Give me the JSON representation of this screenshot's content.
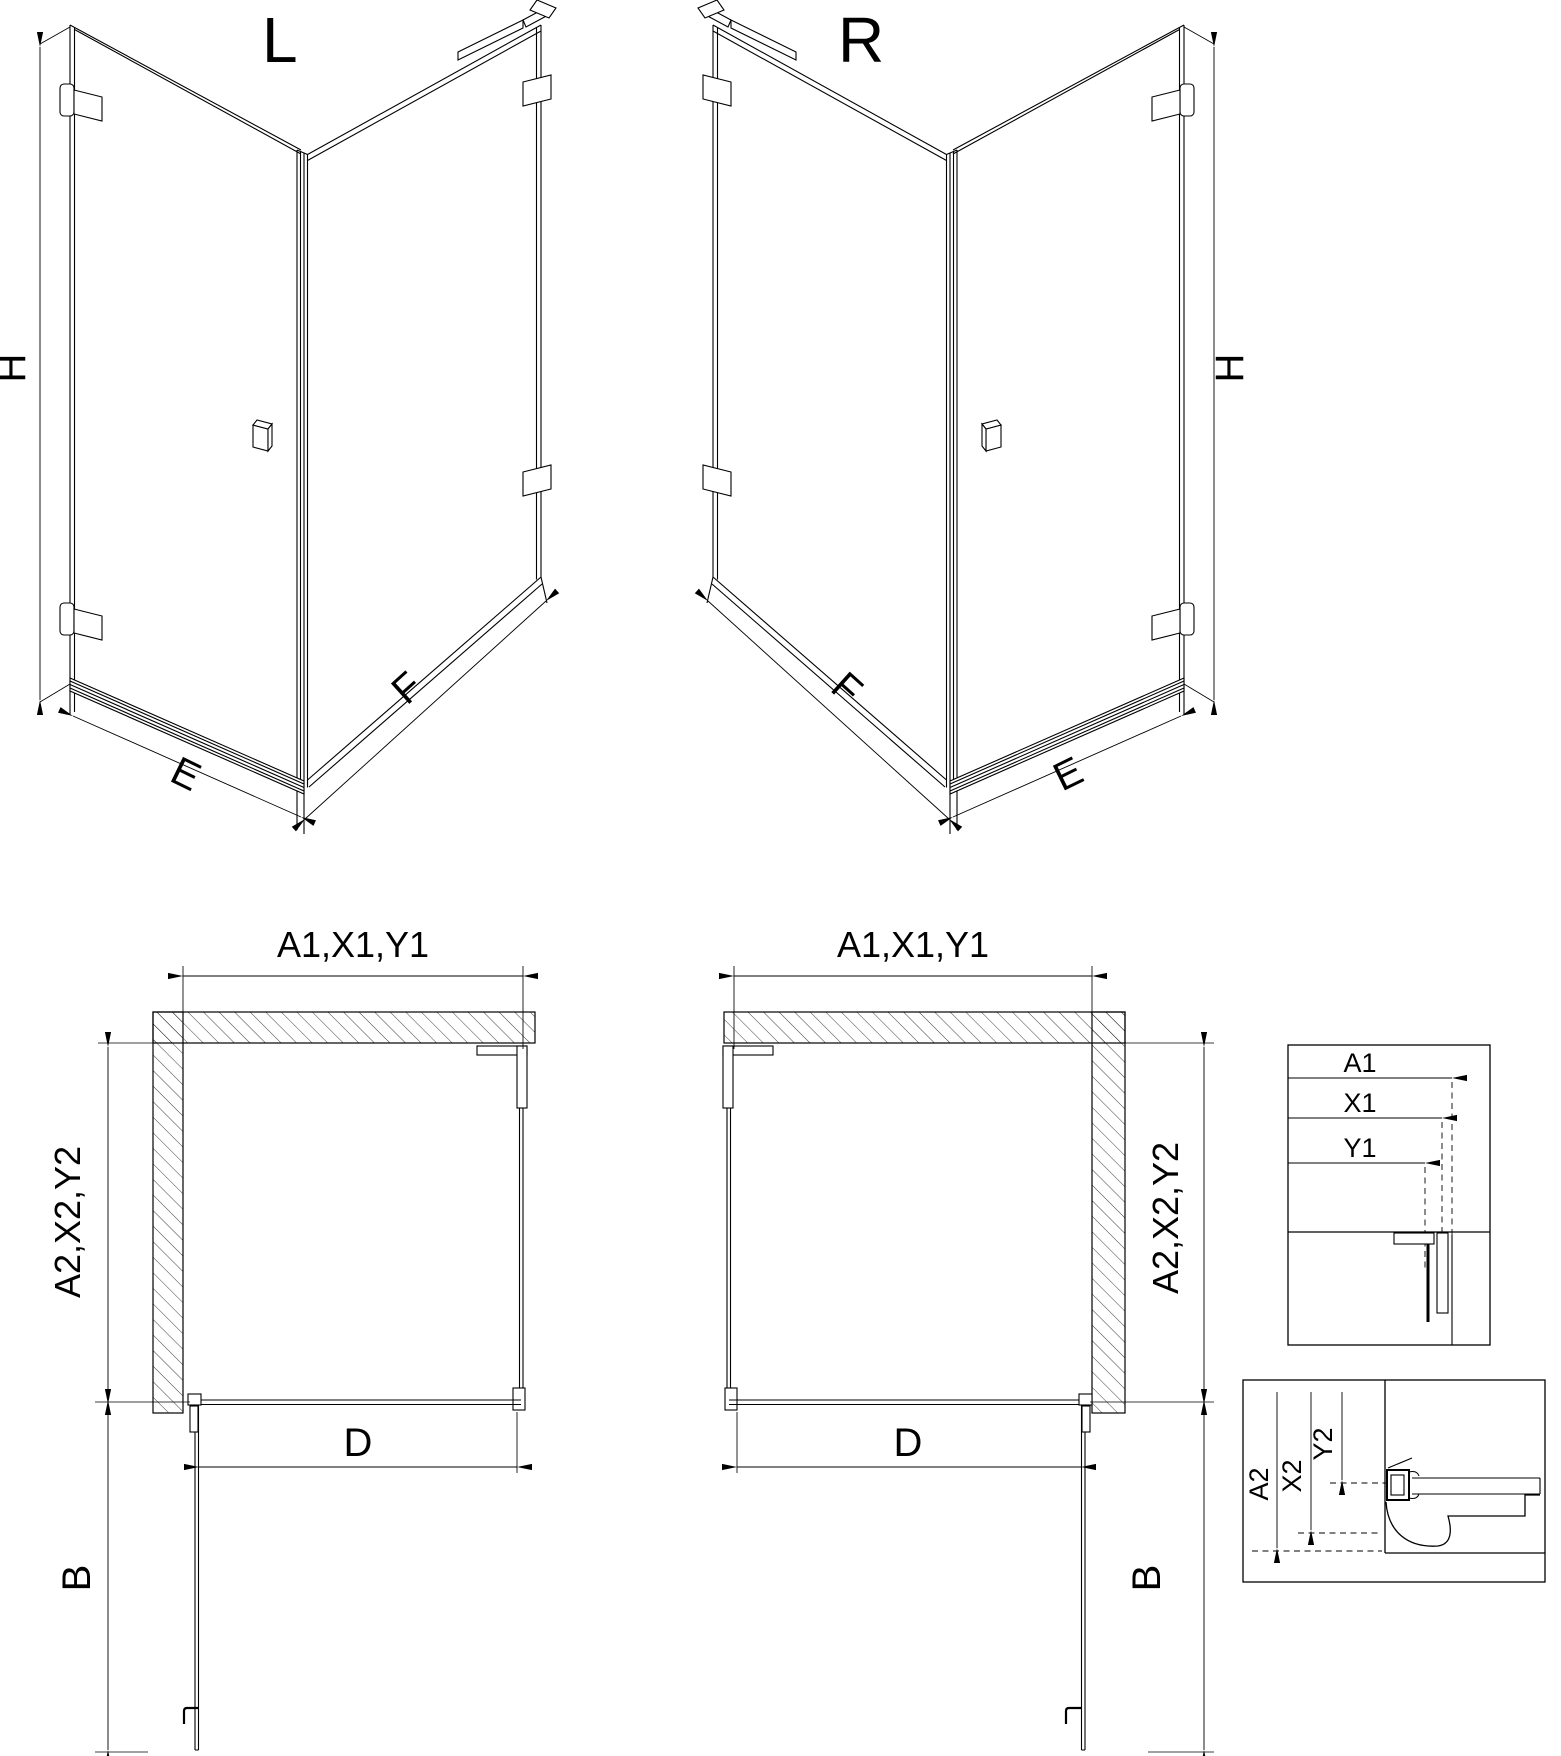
{
  "page": {
    "background": "#ffffff",
    "line_color": "#000000"
  },
  "iso_l": {
    "title": "L",
    "dim_height": "H",
    "dim_door_width": "E",
    "dim_side_width": "F"
  },
  "iso_r": {
    "title": "R",
    "dim_height": "H",
    "dim_door_width": "E",
    "dim_side_width": "F"
  },
  "plan_l": {
    "dim_top": "A1,X1,Y1",
    "dim_side": "A2,X2,Y2",
    "dim_door_opening": "D",
    "dim_door_projection": "B"
  },
  "plan_r": {
    "dim_top": "A1,X1,Y1",
    "dim_side": "A2,X2,Y2",
    "dim_door_opening": "D",
    "dim_door_projection": "B"
  },
  "detail_width_offsets": {
    "labels": [
      "A1",
      "X1",
      "Y1"
    ]
  },
  "detail_depth_offsets": {
    "labels": [
      "A2",
      "X2",
      "Y2"
    ]
  }
}
